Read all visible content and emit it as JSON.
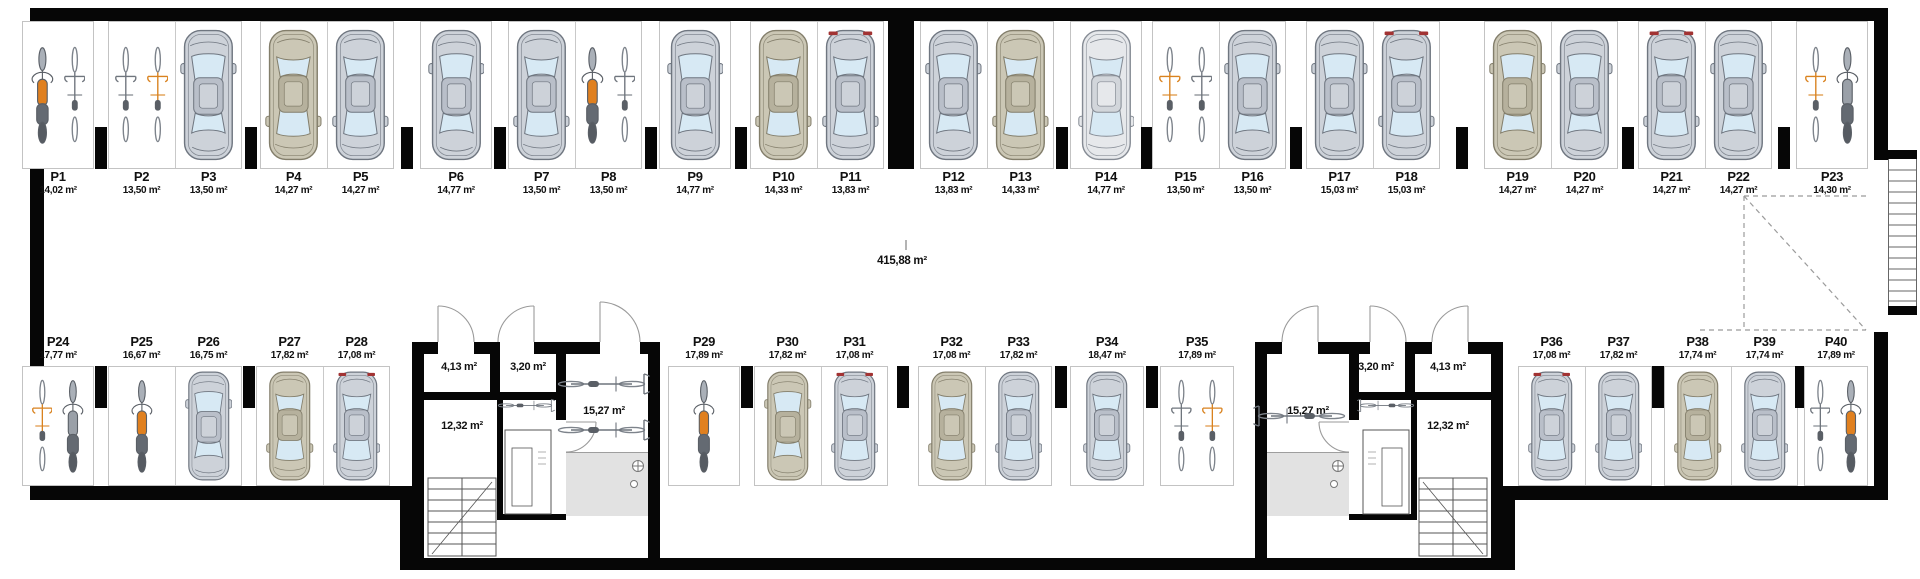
{
  "plan": {
    "name": "underground garage floor plan"
  },
  "aisle": {
    "area": "415,88 m²"
  },
  "rooms": {
    "stairwell_area": "12,32 m²",
    "corridor_area": "3,20 m²",
    "vestibule_area": "4,13 m²",
    "bike_room_area": "15,27 m²"
  },
  "colors": {
    "wall": "#060606",
    "car_gray": "#cdd2d9",
    "car_tan": "#cbc7b5",
    "car_white": "#e6e8eb",
    "glass": "#d7e9f4",
    "moto_orange": "#e0801f",
    "tail_red": "#a23333"
  },
  "stalls": [
    {
      "id": "P1",
      "area": "14,02 m²",
      "row": "top",
      "vehicles": [
        {
          "type": "moto",
          "color": "orange"
        },
        {
          "type": "bike",
          "color": "gray"
        }
      ]
    },
    {
      "id": "P2",
      "area": "13,50 m²",
      "row": "top",
      "vehicles": [
        {
          "type": "bike",
          "color": "gray"
        },
        {
          "type": "bike",
          "color": "orange"
        }
      ]
    },
    {
      "id": "P3",
      "area": "13,50 m²",
      "row": "top",
      "vehicles": [
        {
          "type": "car",
          "color": "gray",
          "facing": "up"
        }
      ]
    },
    {
      "id": "P4",
      "area": "14,27 m²",
      "row": "top",
      "vehicles": [
        {
          "type": "car",
          "color": "tan",
          "facing": "down"
        }
      ]
    },
    {
      "id": "P5",
      "area": "14,27 m²",
      "row": "top",
      "vehicles": [
        {
          "type": "car",
          "color": "gray",
          "facing": "down"
        }
      ]
    },
    {
      "id": "P6",
      "area": "14,77 m²",
      "row": "top",
      "vehicles": [
        {
          "type": "car",
          "color": "gray",
          "facing": "up"
        }
      ]
    },
    {
      "id": "P7",
      "area": "13,50 m²",
      "row": "top",
      "vehicles": [
        {
          "type": "car",
          "color": "gray",
          "facing": "down"
        }
      ]
    },
    {
      "id": "P8",
      "area": "13,50 m²",
      "row": "top",
      "vehicles": [
        {
          "type": "moto",
          "color": "orange"
        },
        {
          "type": "bike",
          "color": "gray"
        }
      ]
    },
    {
      "id": "P9",
      "area": "14,77 m²",
      "row": "top",
      "vehicles": [
        {
          "type": "car",
          "color": "gray",
          "facing": "up"
        }
      ]
    },
    {
      "id": "P10",
      "area": "14,33 m²",
      "row": "top",
      "vehicles": [
        {
          "type": "car",
          "color": "tan",
          "facing": "down"
        }
      ]
    },
    {
      "id": "P11",
      "area": "13,83 m²",
      "row": "top",
      "vehicles": [
        {
          "type": "car",
          "color": "gray",
          "facing": "down",
          "tail": true
        }
      ]
    },
    {
      "id": "P12",
      "area": "13,83 m²",
      "row": "top",
      "vehicles": [
        {
          "type": "car",
          "color": "gray",
          "facing": "up"
        }
      ]
    },
    {
      "id": "P13",
      "area": "14,33 m²",
      "row": "top",
      "vehicles": [
        {
          "type": "car",
          "color": "tan",
          "facing": "down"
        }
      ]
    },
    {
      "id": "P14",
      "area": "14,77 m²",
      "row": "top",
      "vehicles": [
        {
          "type": "car",
          "color": "white",
          "facing": "down"
        }
      ]
    },
    {
      "id": "P15",
      "area": "13,50 m²",
      "row": "top",
      "vehicles": [
        {
          "type": "bike",
          "color": "orange"
        },
        {
          "type": "bike",
          "color": "gray"
        }
      ]
    },
    {
      "id": "P16",
      "area": "13,50 m²",
      "row": "top",
      "vehicles": [
        {
          "type": "car",
          "color": "gray",
          "facing": "up"
        }
      ]
    },
    {
      "id": "P17",
      "area": "15,03 m²",
      "row": "top",
      "vehicles": [
        {
          "type": "car",
          "color": "gray",
          "facing": "up"
        }
      ]
    },
    {
      "id": "P18",
      "area": "15,03 m²",
      "row": "top",
      "vehicles": [
        {
          "type": "car",
          "color": "gray",
          "facing": "down",
          "tail": true
        }
      ]
    },
    {
      "id": "P19",
      "area": "14,27 m²",
      "row": "top",
      "vehicles": [
        {
          "type": "car",
          "color": "tan",
          "facing": "up"
        }
      ]
    },
    {
      "id": "P20",
      "area": "14,27 m²",
      "row": "top",
      "vehicles": [
        {
          "type": "car",
          "color": "gray",
          "facing": "up"
        }
      ]
    },
    {
      "id": "P21",
      "area": "14,27 m²",
      "row": "top",
      "vehicles": [
        {
          "type": "car",
          "color": "gray",
          "facing": "down",
          "tail": true
        }
      ]
    },
    {
      "id": "P22",
      "area": "14,27 m²",
      "row": "top",
      "vehicles": [
        {
          "type": "car",
          "color": "gray",
          "facing": "up"
        }
      ]
    },
    {
      "id": "P23",
      "area": "14,30 m²",
      "row": "top",
      "vehicles": [
        {
          "type": "bike",
          "color": "orange"
        },
        {
          "type": "moto",
          "color": "gray"
        }
      ]
    },
    {
      "id": "P24",
      "area": "17,77 m²",
      "row": "bottom",
      "vehicles": [
        {
          "type": "bike",
          "color": "orange"
        },
        {
          "type": "moto",
          "color": "gray"
        }
      ]
    },
    {
      "id": "P25",
      "area": "16,67 m²",
      "row": "bottom",
      "vehicles": [
        {
          "type": "moto",
          "color": "orange"
        }
      ]
    },
    {
      "id": "P26",
      "area": "16,75 m²",
      "row": "bottom",
      "vehicles": [
        {
          "type": "car",
          "color": "gray",
          "facing": "up"
        }
      ]
    },
    {
      "id": "P27",
      "area": "17,82 m²",
      "row": "bottom",
      "vehicles": [
        {
          "type": "car",
          "color": "tan",
          "facing": "down"
        }
      ]
    },
    {
      "id": "P28",
      "area": "17,08 m²",
      "row": "bottom",
      "vehicles": [
        {
          "type": "car",
          "color": "gray",
          "facing": "down",
          "tail": true
        }
      ]
    },
    {
      "id": "P29",
      "area": "17,89 m²",
      "row": "bottom",
      "vehicles": [
        {
          "type": "moto",
          "color": "orange"
        }
      ]
    },
    {
      "id": "P30",
      "area": "17,82 m²",
      "row": "bottom",
      "vehicles": [
        {
          "type": "car",
          "color": "tan",
          "facing": "up"
        }
      ]
    },
    {
      "id": "P31",
      "area": "17,08 m²",
      "row": "bottom",
      "vehicles": [
        {
          "type": "car",
          "color": "gray",
          "facing": "down",
          "tail": true
        }
      ]
    },
    {
      "id": "P32",
      "area": "17,08 m²",
      "row": "bottom",
      "vehicles": [
        {
          "type": "car",
          "color": "tan",
          "facing": "down"
        }
      ]
    },
    {
      "id": "P33",
      "area": "17,82 m²",
      "row": "bottom",
      "vehicles": [
        {
          "type": "car",
          "color": "gray",
          "facing": "down"
        }
      ]
    },
    {
      "id": "P34",
      "area": "18,47 m²",
      "row": "bottom",
      "vehicles": [
        {
          "type": "car",
          "color": "gray",
          "facing": "down"
        }
      ]
    },
    {
      "id": "P35",
      "area": "17,89 m²",
      "row": "bottom",
      "vehicles": [
        {
          "type": "bike",
          "color": "gray"
        },
        {
          "type": "bike",
          "color": "orange"
        }
      ]
    },
    {
      "id": "P36",
      "area": "17,08 m²",
      "row": "bottom",
      "vehicles": [
        {
          "type": "car",
          "color": "gray",
          "facing": "down",
          "tail": true
        }
      ]
    },
    {
      "id": "P37",
      "area": "17,82 m²",
      "row": "bottom",
      "vehicles": [
        {
          "type": "car",
          "color": "gray",
          "facing": "down"
        }
      ]
    },
    {
      "id": "P38",
      "area": "17,74 m²",
      "row": "bottom",
      "vehicles": [
        {
          "type": "car",
          "color": "tan",
          "facing": "down"
        }
      ]
    },
    {
      "id": "P39",
      "area": "17,74 m²",
      "row": "bottom",
      "vehicles": [
        {
          "type": "car",
          "color": "gray",
          "facing": "down"
        }
      ]
    },
    {
      "id": "P40",
      "area": "17,89 m²",
      "row": "bottom",
      "vehicles": [
        {
          "type": "bike",
          "color": "gray"
        },
        {
          "type": "moto",
          "color": "orange"
        }
      ]
    }
  ]
}
